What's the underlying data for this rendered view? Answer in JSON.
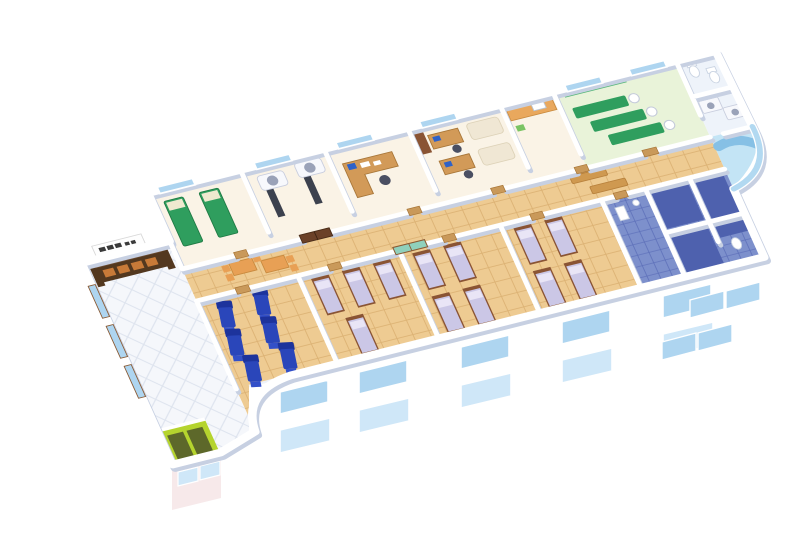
{
  "image_type": "3d-isometric-cutaway-floor-plan",
  "subject": "hospital-clinic-floor-rendering",
  "colors": {
    "background": "#ffffff",
    "wall": "#ffffff",
    "wall_shadow": "#c7d0e2",
    "floor_lobby": "#f5f7fb",
    "tile_line_lobby": "#dde3ee",
    "floor_corridor": "#eecb92",
    "tile_line_corridor": "#dcb274",
    "floor_room": "#faf3e6",
    "floor_therapy": "#e9f3d9",
    "floor_bath": "#7d90cc",
    "tile_line_bath": "#5a6db8",
    "floor_bath_dark": "#4e61ae",
    "floor_service": "#eef3fa",
    "floor_pool": "#c3e4f5",
    "window_glass": "#aed5f0",
    "window_glass_light": "#cfe7f8",
    "door_wood": "#c9995a",
    "door_dark": "#6b4128",
    "door_glass": "#8fd0bc",
    "desk_wood": "#d29a58",
    "counter_orange": "#e9a85d",
    "table_orange": "#e8a055",
    "bench_wood": "#cf9950",
    "bed_green": "#2f9e5e",
    "therapy_panel_green": "#59b87c",
    "mattress_lavender": "#cbc7e6",
    "pillow_lavender": "#e9e5f6",
    "bed_frame_wood": "#8a5434",
    "recliner_blue": "#2a46ba",
    "recliner_blue_dark": "#1d339c",
    "recliner_blue_light": "#3350c8",
    "couch_cream": "#f0e7d4",
    "scanner_white": "#f7f8fc",
    "scanner_ring": "#9aa2b8",
    "scanner_table": "#3c414e",
    "monitor_blue": "#2f62c8",
    "chair_gray": "#4a4f62",
    "elevator_green": "#b5d42e",
    "elevator_dark": "#5d682a",
    "reception_desk": "#53381f",
    "reception_top": "#6b4a30",
    "reception_front": "#c87a38",
    "sign_board": "#fefefe",
    "sign_text": "#3a3a3a",
    "fixture_white": "#ffffff",
    "fixture_line": "#c9d3e2",
    "pool_couch": "#86c0e5",
    "glass_wall": "#a5d2ef",
    "facade_tint": "#eef2f9",
    "facade_pink": "#f7e9ea",
    "plant_green": "#7ac464"
  },
  "rooms": [
    {
      "id": "lobby",
      "label": "entrance-lobby",
      "floor": "white-diamond-tile"
    },
    {
      "id": "exam-room",
      "label": "exam-room",
      "green_beds": 2
    },
    {
      "id": "ct-room",
      "label": "ct-scanner-room",
      "scanners": 2
    },
    {
      "id": "consult-room",
      "label": "consultation-office",
      "desks": 1
    },
    {
      "id": "staff-office",
      "label": "staff-office",
      "desks": 2,
      "couches": 2
    },
    {
      "id": "pantry",
      "label": "pantry-counter-room",
      "counters": 1
    },
    {
      "id": "therapy-room",
      "label": "physiotherapy-room",
      "mats": 3,
      "devices": 3
    },
    {
      "id": "wc",
      "label": "toilet-room",
      "toilets": 2
    },
    {
      "id": "imaging-room",
      "label": "imaging-equipment-room",
      "machines": 2
    },
    {
      "id": "pool-lounge",
      "label": "curved-glass-lounge",
      "curved_couches": 1
    },
    {
      "id": "corridor",
      "label": "central-corridor",
      "benches": 2,
      "tables": 2
    },
    {
      "id": "recliner-room",
      "label": "infusion-recliner-room",
      "recliners": 6
    },
    {
      "id": "ward-1",
      "label": "patient-ward",
      "beds": 4
    },
    {
      "id": "ward-2",
      "label": "patient-ward",
      "beds": 4
    },
    {
      "id": "ward-3",
      "label": "patient-ward",
      "beds": 4
    },
    {
      "id": "bathrooms",
      "label": "shower-toilet-block",
      "stalls": 3
    }
  ],
  "facade": {
    "front_upper_windows": 5,
    "front_lower_windows": 5,
    "side_windows": 4,
    "lobby_windows": 2,
    "back_wall_windows": 6,
    "left_wall_windows": 3
  }
}
